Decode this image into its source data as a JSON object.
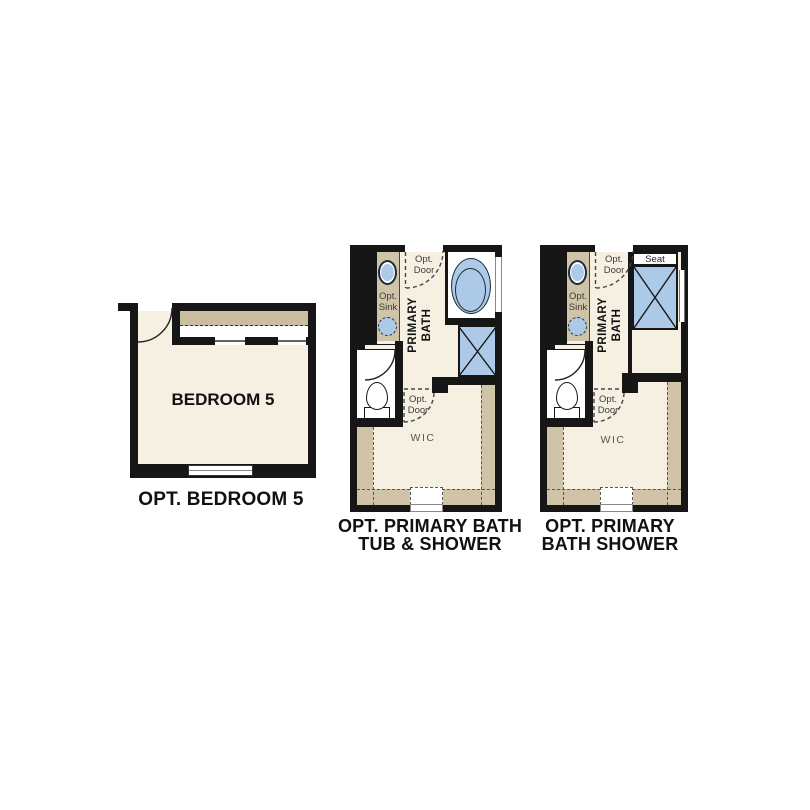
{
  "colors": {
    "wall": "#161616",
    "floor": "#f6f0e2",
    "counter_tan": "#cfc3a8",
    "fixture_blue": "#adc9e8",
    "caption_text": "#111111",
    "annotation_text": "#3d3d3d"
  },
  "plans": {
    "bedroom5": {
      "room_name": "BEDROOM 5",
      "caption": "OPT. BEDROOM 5"
    },
    "primary_bath_tub_shower": {
      "caption_line1": "OPT. PRIMARY BATH",
      "caption_line2": "TUB & SHOWER",
      "room_line1": "PRIMARY",
      "room_line2": "BATH",
      "closet_label": "WIC",
      "opt_sink_line1": "Opt.",
      "opt_sink_line2": "Sink",
      "opt_door_top_line1": "Opt.",
      "opt_door_top_line2": "Door",
      "opt_door_wic_line1": "Opt.",
      "opt_door_wic_line2": "Door"
    },
    "primary_bath_shower": {
      "caption_line1": "OPT. PRIMARY",
      "caption_line2": "BATH SHOWER",
      "room_line1": "PRIMARY",
      "room_line2": "BATH",
      "closet_label": "WIC",
      "seat_label": "Seat",
      "opt_sink_line1": "Opt.",
      "opt_sink_line2": "Sink",
      "opt_door_top_line1": "Opt.",
      "opt_door_top_line2": "Door",
      "opt_door_wic_line1": "Opt.",
      "opt_door_wic_line2": "Door"
    }
  }
}
